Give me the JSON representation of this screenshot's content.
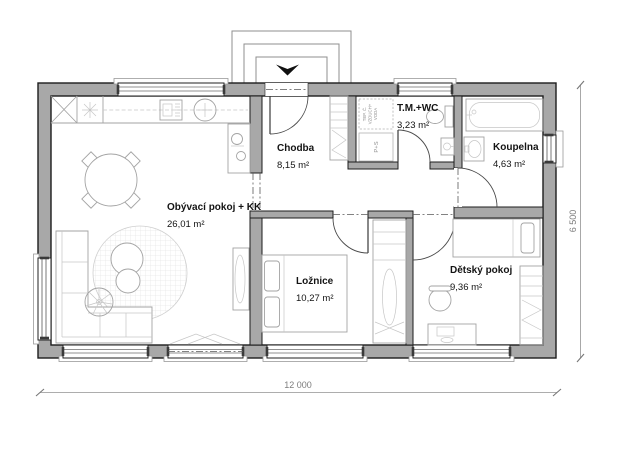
{
  "rooms": {
    "living": {
      "name": "Obývací pokoj + KK",
      "area": "26,01 m²"
    },
    "hall": {
      "name": "Chodba",
      "area": "8,15 m²"
    },
    "tech_wc": {
      "name": "T.M.+WC",
      "area": "3,23 m²"
    },
    "bathroom": {
      "name": "Koupelna",
      "area": "4,63 m²"
    },
    "bedroom": {
      "name": "Ložnice",
      "area": "10,27 m²"
    },
    "kids_room": {
      "name": "Dětský pokoj",
      "area": "9,36 m²"
    }
  },
  "equipment": {
    "heat_pump_line1": "TEP. Č.",
    "heat_pump_line2": "VZDUCH+",
    "heat_pump_line3": "VODA",
    "washer_dryer": "P+S"
  },
  "dimensions": {
    "overall_width": "12 000",
    "overall_height": "6 500"
  },
  "colors": {
    "wall_fill": "#a8a8a8",
    "wall_outline": "#1c1c1c",
    "furniture_line": "#a3a3a3",
    "dimension_line": "#929292"
  }
}
